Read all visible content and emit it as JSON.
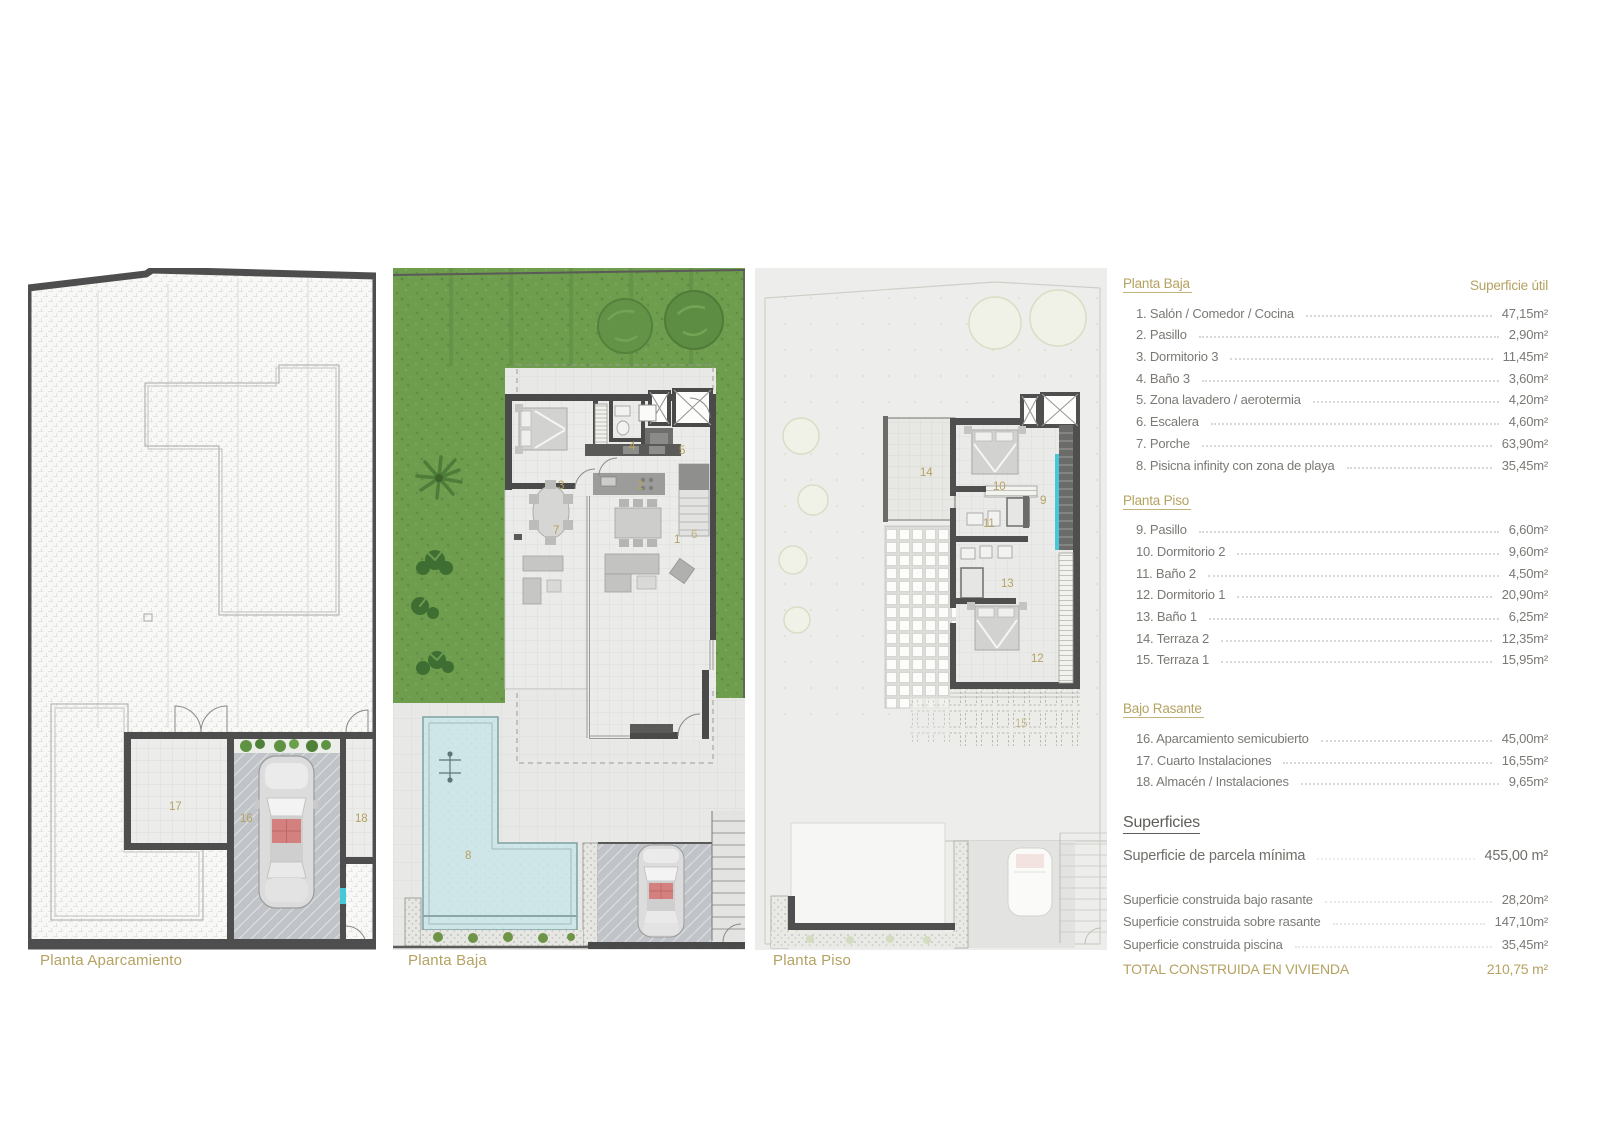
{
  "plan_titles": {
    "p1": "Planta Aparcamiento",
    "p2": "Planta Baja",
    "p3": "Planta Piso"
  },
  "rooms": {
    "n1": "1",
    "n2": "2",
    "n3": "3",
    "n4": "4",
    "n5": "5",
    "n6": "6",
    "n7": "7",
    "n8": "8",
    "n9": "9",
    "n10": "10",
    "n11": "11",
    "n12": "12",
    "n13": "13",
    "n14": "14",
    "n15": "15",
    "n16": "16",
    "n17": "17",
    "n18": "18"
  },
  "legend": {
    "col_header": "Superficie útil",
    "sections": [
      {
        "title": "Planta Baja",
        "items": [
          {
            "label": "1. Salón / Comedor / Cocina",
            "value": "47,15m²"
          },
          {
            "label": "2. Pasillo",
            "value": "2,90m²"
          },
          {
            "label": "3. Dormitorio 3",
            "value": "11,45m²"
          },
          {
            "label": "4. Baño 3",
            "value": "3,60m²"
          },
          {
            "label": "5. Zona lavadero / aerotermia",
            "value": "4,20m²"
          },
          {
            "label": "6. Escalera",
            "value": "4,60m²"
          },
          {
            "label": "7. Porche",
            "value": "63,90m²"
          },
          {
            "label": "8. Pisicna infinity con zona de playa",
            "value": "35,45m²"
          }
        ]
      },
      {
        "title": "Planta Piso",
        "items": [
          {
            "label": "9. Pasillo",
            "value": "6,60m²"
          },
          {
            "label": "10. Dormitorio 2",
            "value": "9,60m²"
          },
          {
            "label": "11. Baño 2",
            "value": "4,50m²"
          },
          {
            "label": "12. Dormitorio 1",
            "value": "20,90m²"
          },
          {
            "label": "13. Baño 1",
            "value": "6,25m²"
          },
          {
            "label": "14. Terraza 2",
            "value": "12,35m²"
          },
          {
            "label": "15. Terraza 1",
            "value": "15,95m²"
          }
        ]
      },
      {
        "title": "Bajo Rasante",
        "items": [
          {
            "label": "16. Aparcamiento semicubierto",
            "value": "45,00m²"
          },
          {
            "label": "17. Cuarto Instalaciones",
            "value": "16,55m²"
          },
          {
            "label": "18. Almacén / Instalaciones",
            "value": "9,65m²"
          }
        ]
      }
    ],
    "summary": {
      "title": "Superficies",
      "parcela_label": "Superficie de parcela mínima",
      "parcela_value": "455,00 m²",
      "rows": [
        {
          "label": "Superficie construida bajo rasante",
          "value": "28,20m²"
        },
        {
          "label": "Superficie construida sobre rasante",
          "value": "147,10m²"
        },
        {
          "label": "Superficie construida piscina",
          "value": "35,45m²"
        }
      ],
      "total_label": "TOTAL CONSTRUIDA EN VIVIENDA",
      "total_value": "210,75 m²"
    }
  },
  "colors": {
    "accent_gold": "#b5a262",
    "wall_dark": "#4e4e4e",
    "grass_green": "#6f9d4e",
    "pool_blue": "#cfe6e8",
    "glass_cyan": "#45c8d8",
    "text_gray": "#7b7974"
  }
}
